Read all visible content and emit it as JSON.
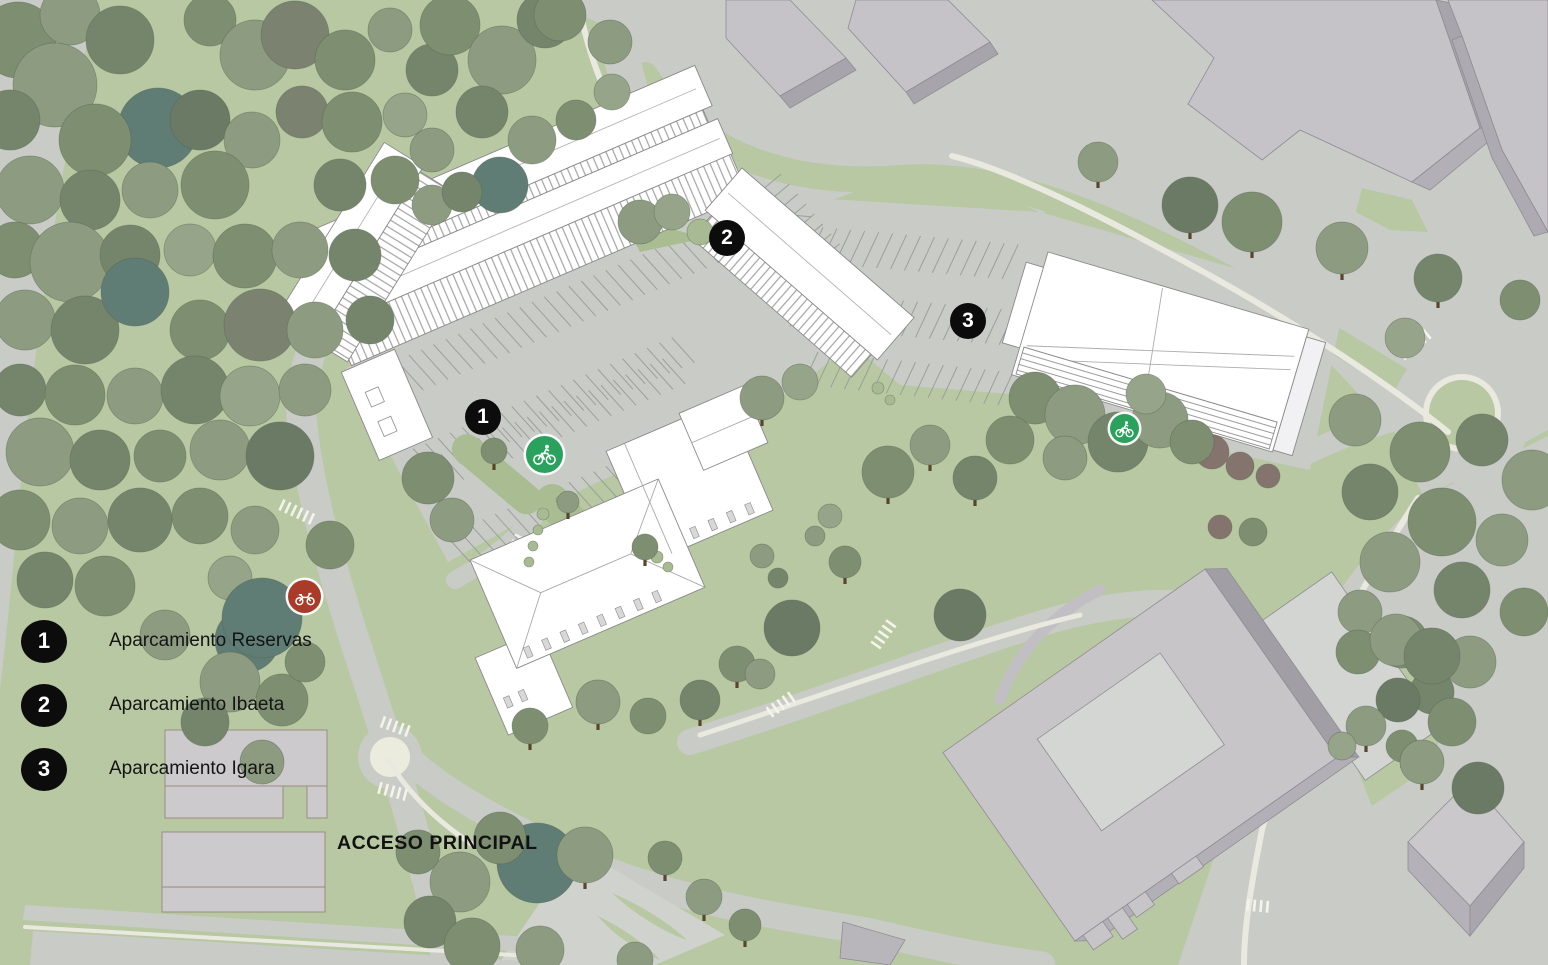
{
  "map": {
    "access_label": "ACCESO PRINCIPAL",
    "legend": [
      {
        "number": "1",
        "label": "Aparcamiento Reservas"
      },
      {
        "number": "2",
        "label": "Aparcamiento Ibaeta"
      },
      {
        "number": "3",
        "label": "Aparcamiento Igara"
      }
    ],
    "markers": [
      {
        "number": "1"
      },
      {
        "number": "2"
      },
      {
        "number": "3"
      }
    ],
    "icon_markers": {
      "motorcycle": {
        "name": "motorcycle-parking",
        "color": "#a93b28"
      },
      "bicycle": {
        "name": "bicycle-parking",
        "color": "#2aa15c"
      }
    },
    "colors": {
      "background_green": "#b7c8a2",
      "road_gray": "#c9cbc6",
      "sidewalk_cream": "#e9e9df",
      "building_white": "#ffffff",
      "context_building_gray": "#c6c3c8",
      "context_building_side": "#a8a4ac",
      "marker_black": "#0c0c0c",
      "moto_red": "#a93b28",
      "bike_green": "#2aa15c"
    }
  }
}
